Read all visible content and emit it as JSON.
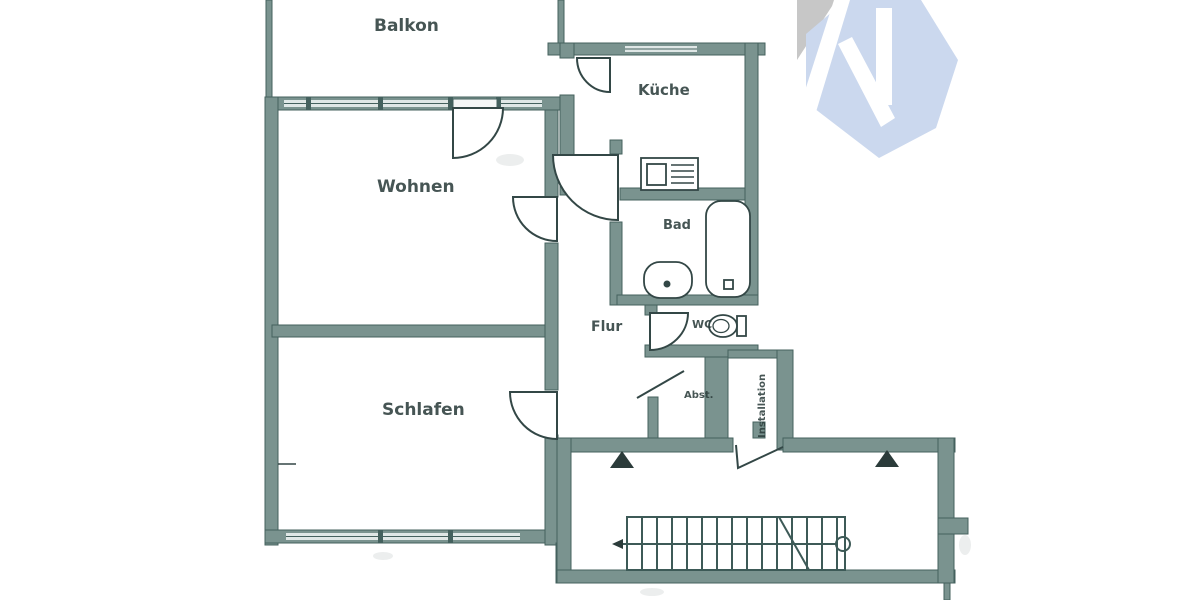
{
  "floorplan": {
    "wall_color": "#7a938f",
    "line_color": "#334746",
    "rooms": [
      {
        "id": "balkon",
        "label": "Balkon"
      },
      {
        "id": "wohnen",
        "label": "Wohnen"
      },
      {
        "id": "kueche",
        "label": "Küche"
      },
      {
        "id": "bad",
        "label": "Bad"
      },
      {
        "id": "flur",
        "label": "Flur"
      },
      {
        "id": "wc",
        "label": "WC"
      },
      {
        "id": "schlafen",
        "label": "Schlafen"
      },
      {
        "id": "abstellraum",
        "label": "Abst."
      },
      {
        "id": "installation",
        "label": "Installation"
      }
    ]
  },
  "watermark": {
    "letters": "KI",
    "hex_color": "#cbd8ee",
    "gray_color": "#c7c7c7"
  }
}
